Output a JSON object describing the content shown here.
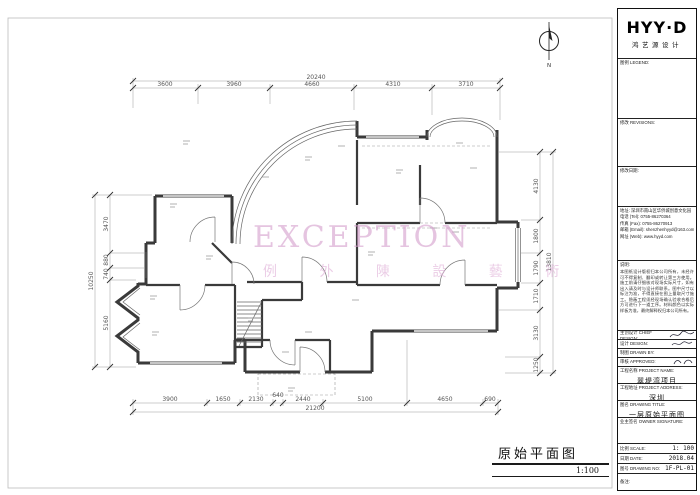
{
  "watermark": {
    "line1": "EXCEPTION",
    "line2": "例 外 陳 設 藝 術"
  },
  "north": {
    "label": "N"
  },
  "drawing_title": {
    "title": "原始平面图",
    "scale": "1:100"
  },
  "dims": {
    "top": {
      "overall": "20240",
      "segments": [
        "3600",
        "3960",
        "4660",
        "4310",
        "3710"
      ]
    },
    "bottom": {
      "overall": "21200",
      "segments": [
        "3900",
        "1650",
        "2130",
        "640",
        "2440",
        "5100",
        "4650",
        "690"
      ]
    },
    "left": {
      "overall": "10250",
      "segments": [
        "3470",
        "880",
        "740",
        "5160"
      ]
    },
    "right": {
      "overall": "13810",
      "segments": [
        "4130",
        "1800",
        "1790",
        "1710",
        "3130",
        "1250"
      ]
    }
  },
  "titleblock": {
    "logo": "HYY·D",
    "logo_sub": "鸿艺源设计",
    "legend_label": "图例 LEGEND:",
    "revisions_label": "修改 REVISIONS:",
    "revdate_label": "修改日期:",
    "address_label": "地址:",
    "address": "深圳市南山区华侨城创意文化园",
    "tel_label": "电话 (Tel):",
    "tel": "0755-86270364",
    "fax_label": "传真 (Fax):",
    "fax": "0755-86270913",
    "email_label": "邮箱 (Email):",
    "email": "shenzhenhyyd@163.com",
    "web_label": "网址 (Web):",
    "web": "www.hyyd.com",
    "notes_label": "说明:",
    "notes": "本图纸设计版权归本公司所有，未经许可不得复制、翻印或转让第三方使用。施工前请仔细核对现场实际尺寸，如有出入请及时与设计师联系。图中尺寸以标注为准，不得直接在图上量取尺寸施工。隐蔽工程须经现场确认验收合格后方可进行下一道工序。材料颜色以实际样板为准，最终解释权归本公司所有。",
    "rows": [
      {
        "label": "主创设计 CHIEF DESIGN:"
      },
      {
        "label": "设计 DESIGN:"
      },
      {
        "label": "制图 DRAWN BY:"
      },
      {
        "label": "审核 APPROVED:"
      }
    ],
    "project_name_label": "工程名称 PROJECT NAME:",
    "project_name": "翠堤湾项目",
    "project_addr_label": "工程地址 PROJECT ADDRESS:",
    "project_addr": "深圳",
    "drawing_title_label": "图名 DRAWING TITLE:",
    "drawing_title": "一层原始平面图",
    "owner_sign_label": "业主签名 OWNER SIGNATURE:",
    "scale_label": "比例 SCALE:",
    "scale": "1: 100",
    "date_label": "日期 DATE:",
    "date": "2018.04",
    "no_label": "图号 DRAWING NO:",
    "no": "1F-PL-01",
    "remark_label": "备注:"
  }
}
